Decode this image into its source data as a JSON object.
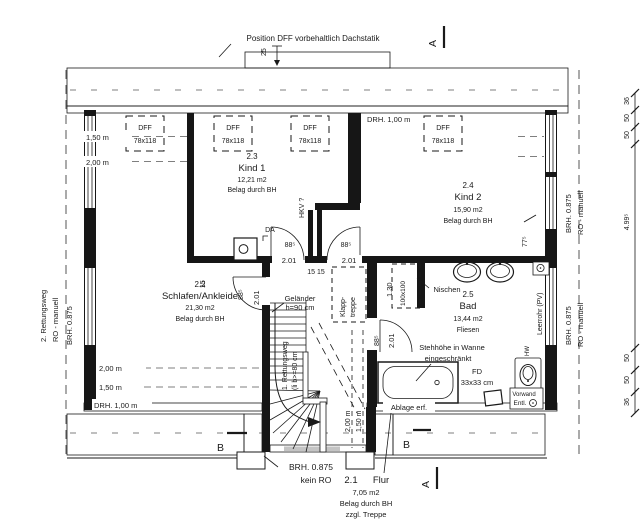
{
  "annotations": {
    "top_note": "Position DFF vorbehaltlich Dachstatik",
    "dim_25": "25",
    "da": "DA",
    "hkv": "HKV ?",
    "nische": "Nischen",
    "stehhoehe_1": "Stehhöhe in Wanne",
    "stehhoehe_2": "eingeschränkt",
    "ablage": "Ablage erf.",
    "fd": "FD",
    "fd_size": "33x33 cm",
    "vorwand": "Vorwand",
    "entl": "Entl.",
    "leerrohr": "Leerrohr (PV)",
    "hw": "HW",
    "gelaender_1": "Geländer",
    "gelaender_2": "h=90 cm",
    "rettungsweg_stair_1": "1. Rettungsweg",
    "rettungsweg_stair_2": "(li b>=80 cm",
    "klapptreppe_1": "Klapp-",
    "klapptreppe_2": "treppe"
  },
  "rooms": {
    "flur": {
      "number": "2.1",
      "name": "Flur",
      "area": "7,05 m2",
      "note": "Belag durch BH",
      "note2": "zzgl. Treppe"
    },
    "schlafen": {
      "number": "2.2",
      "name": "Schlafen/Ankleide",
      "area": "21,30 m2",
      "note": "Belag durch BH"
    },
    "kind1": {
      "number": "2.3",
      "name": "Kind 1",
      "area": "12,21 m2",
      "note": "Belag durch BH"
    },
    "kind2": {
      "number": "2.4",
      "name": "Kind 2",
      "area": "15,90 m2",
      "note": "Belag durch BH"
    },
    "bad": {
      "number": "2.5",
      "name": "Bad",
      "area": "13,44 m2",
      "note": "Fliesen"
    }
  },
  "windows": {
    "dff_label": "DFF",
    "dff_size": "78x118",
    "drh_top": "DRH. 1,00 m",
    "drh_bottom": "DRH. 1,00 m",
    "brh": "BRH. 0.875",
    "ro_manuell": "RO - manuell",
    "rettungsweg2": "2. Rettungsweg",
    "stair_brh": "BRH. 0.875",
    "stair_ro": "kein RO"
  },
  "heights": {
    "h150": "1,50 m",
    "h200": "2,00 m"
  },
  "dims": {
    "door_width": "88⁵",
    "door_clear": "2.01",
    "wall_15": "15",
    "wall_15_15": "15 15",
    "niche_h": "1.30",
    "niche_size": "100x100",
    "window_77": "77⁵",
    "chain": [
      "36",
      "50",
      "50",
      "4.99⁵",
      "50",
      "50",
      "36"
    ]
  },
  "sections": {
    "a": "A",
    "b": "B"
  }
}
